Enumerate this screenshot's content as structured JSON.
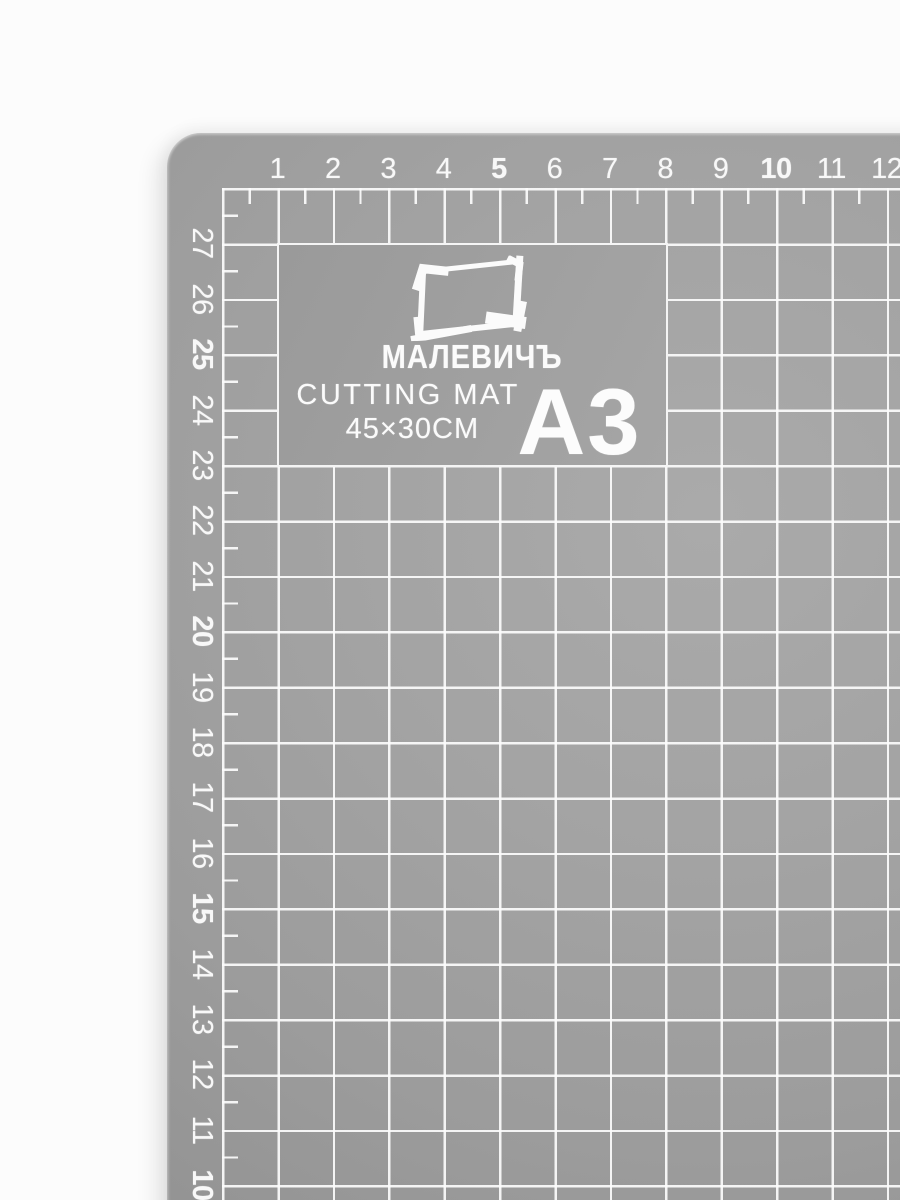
{
  "product": {
    "brand": "МАЛЕВИЧЪ",
    "title": "CUTTING MAT",
    "dimensions": "45×30CM",
    "format": "A3"
  },
  "ruler": {
    "top": [
      {
        "label": "1",
        "bold": false
      },
      {
        "label": "2",
        "bold": false
      },
      {
        "label": "3",
        "bold": false
      },
      {
        "label": "4",
        "bold": false
      },
      {
        "label": "5",
        "bold": true
      },
      {
        "label": "6",
        "bold": false
      },
      {
        "label": "7",
        "bold": false
      },
      {
        "label": "8",
        "bold": false
      },
      {
        "label": "9",
        "bold": false
      },
      {
        "label": "10",
        "bold": true
      },
      {
        "label": "11",
        "bold": false
      },
      {
        "label": "12",
        "bold": false
      }
    ],
    "left": [
      {
        "label": "27",
        "bold": false
      },
      {
        "label": "26",
        "bold": false
      },
      {
        "label": "25",
        "bold": true
      },
      {
        "label": "24",
        "bold": false
      },
      {
        "label": "23",
        "bold": false
      },
      {
        "label": "22",
        "bold": false
      },
      {
        "label": "21",
        "bold": false
      },
      {
        "label": "20",
        "bold": true
      },
      {
        "label": "19",
        "bold": false
      },
      {
        "label": "18",
        "bold": false
      },
      {
        "label": "17",
        "bold": false
      },
      {
        "label": "16",
        "bold": false
      },
      {
        "label": "15",
        "bold": true
      },
      {
        "label": "14",
        "bold": false
      },
      {
        "label": "13",
        "bold": false
      },
      {
        "label": "12",
        "bold": false
      },
      {
        "label": "11",
        "bold": false
      },
      {
        "label": "10",
        "bold": true
      }
    ]
  },
  "colors": {
    "mat": "#a1a1a1",
    "lines": "#f7f7f7",
    "background": "#fcfcfc"
  }
}
